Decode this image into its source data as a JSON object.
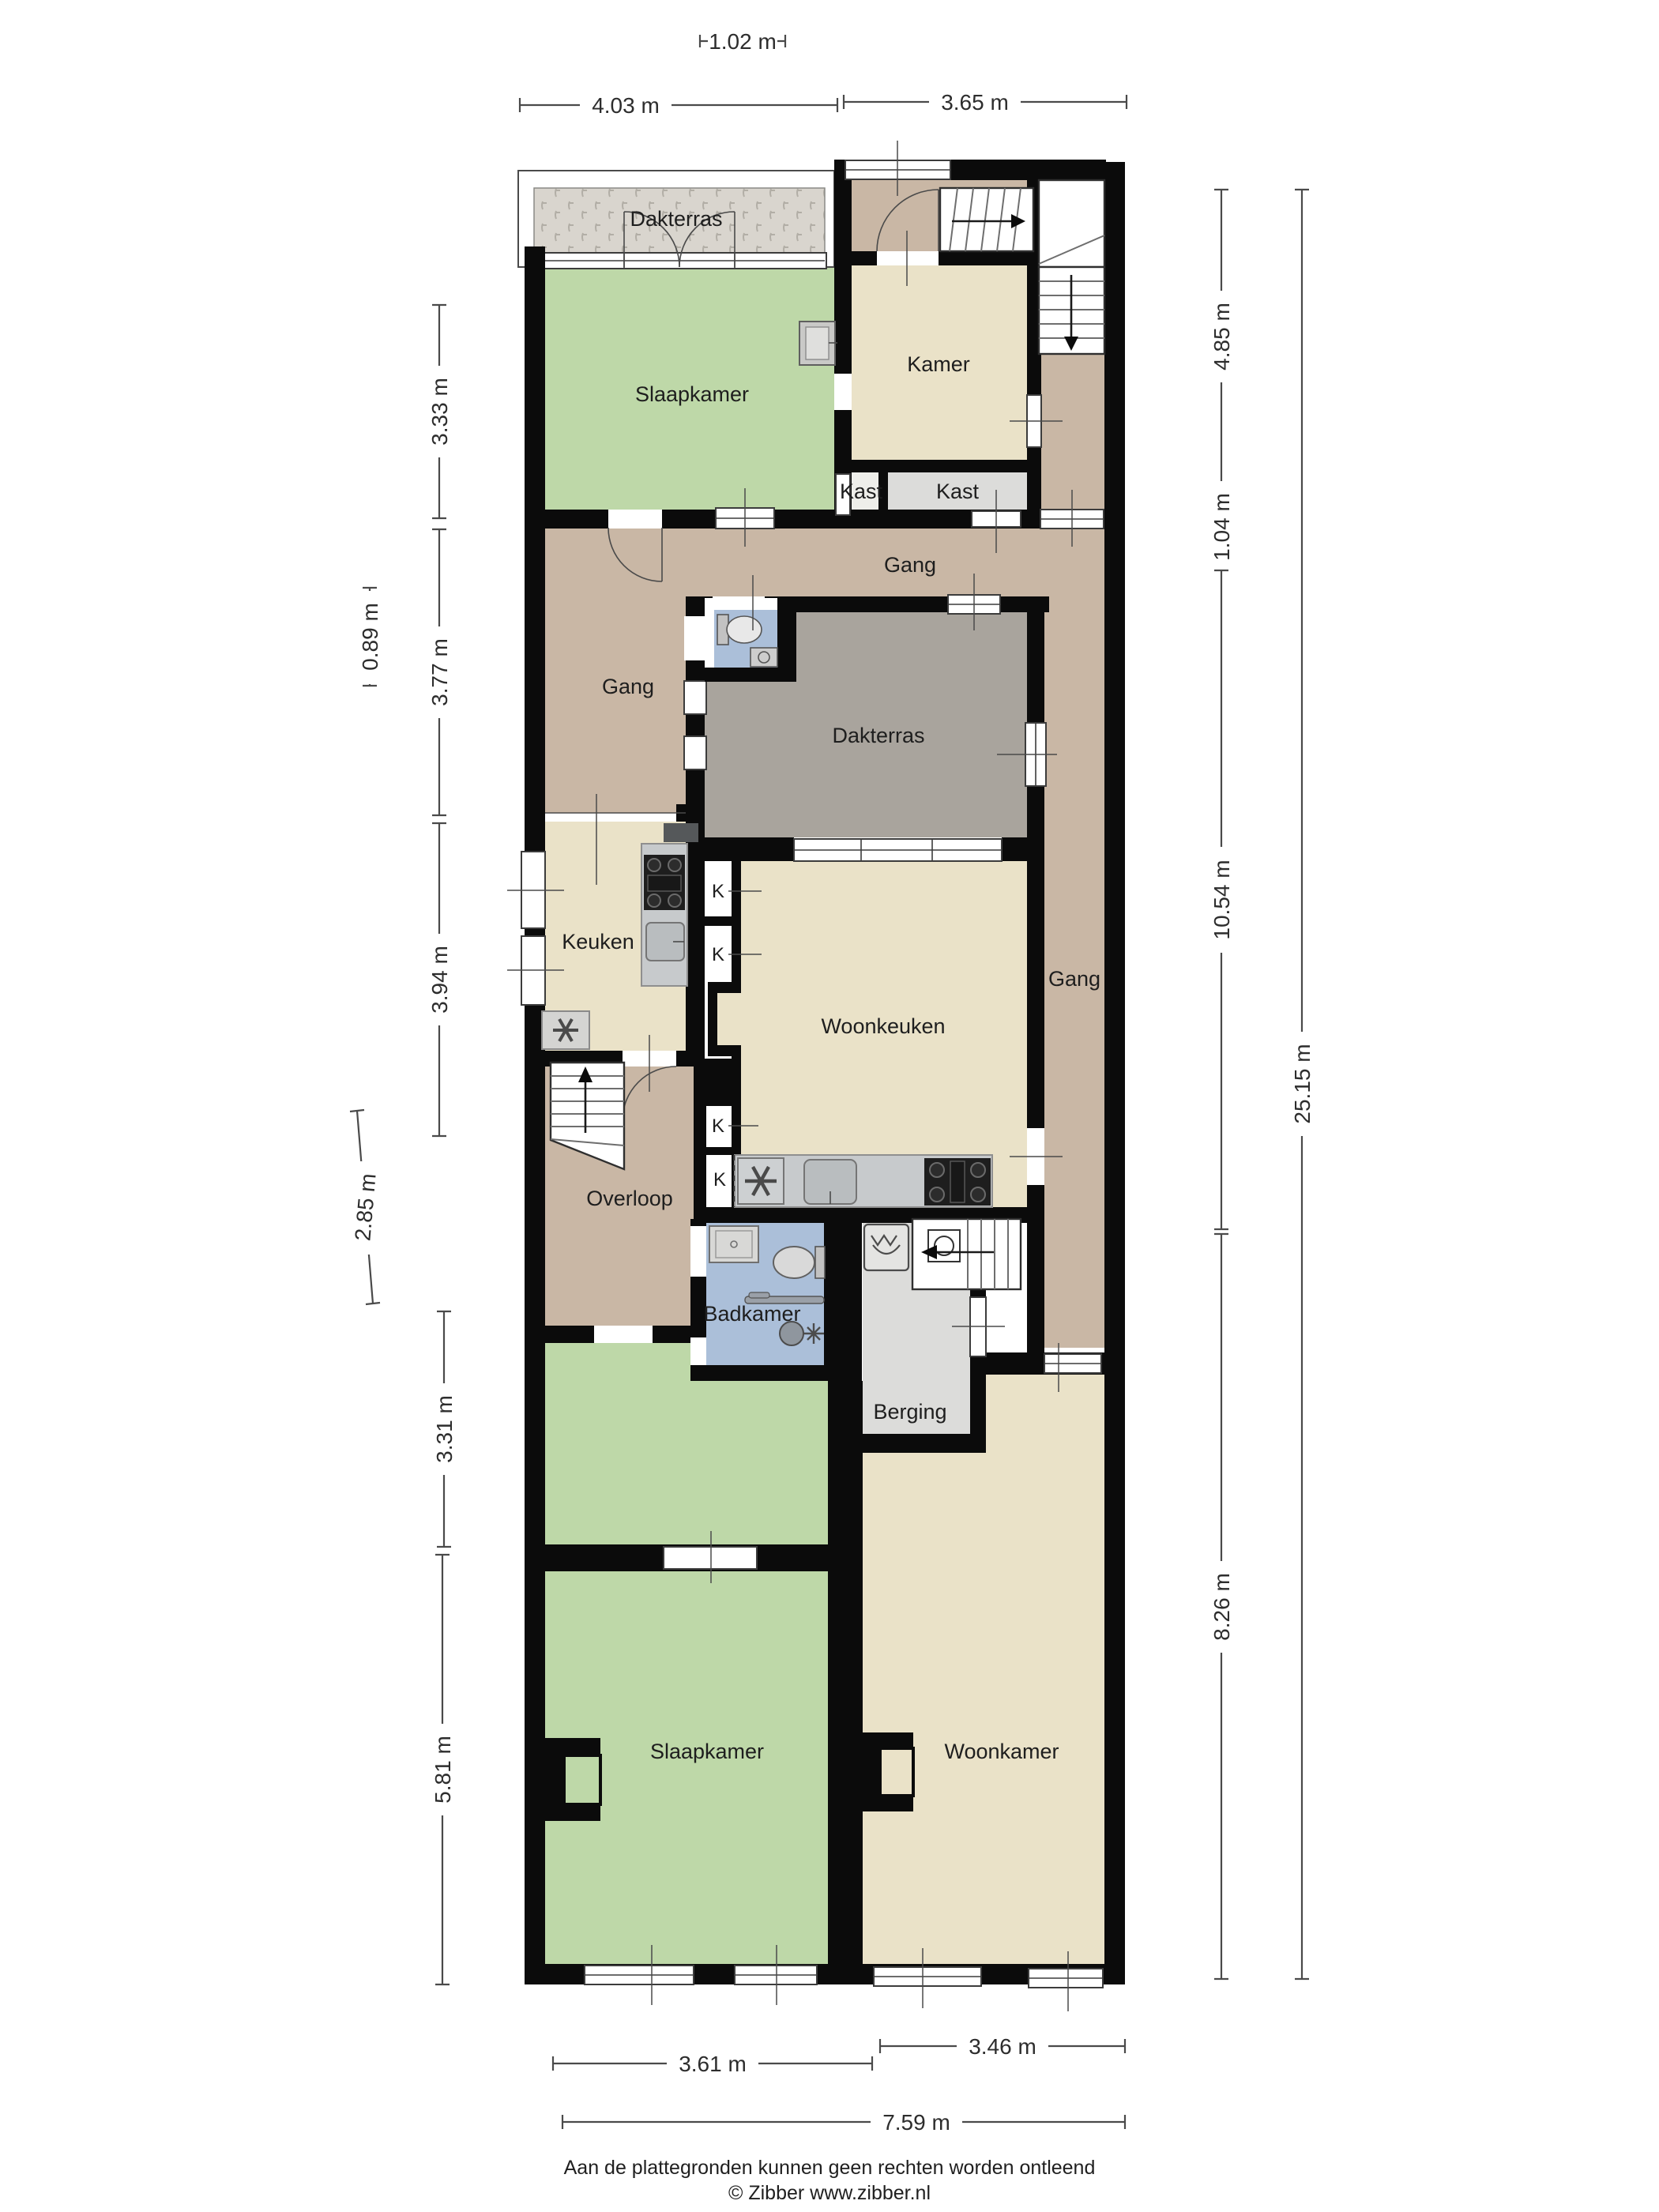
{
  "colors": {
    "wall": "#0b0b0b",
    "room_green": "#bed8a8",
    "room_beige": "#eae2c8",
    "room_brown": "#c9b7a5",
    "room_gray_terrace": "#a9a49d",
    "room_blue": "#abbfd9",
    "room_lightgray": "#dcdcda",
    "room_cell": "#eeeeea",
    "counter_gray": "#c7cacc",
    "stove_black": "#1e1e1e",
    "hatch_base": "#d9d5ce"
  },
  "rooms": [
    {
      "id": "dakterras-top",
      "label": "Dakterras"
    },
    {
      "id": "slaapkamer-top",
      "label": "Slaapkamer"
    },
    {
      "id": "kamer",
      "label": "Kamer"
    },
    {
      "id": "kast-small",
      "label": "Kast"
    },
    {
      "id": "kast-large",
      "label": "Kast"
    },
    {
      "id": "gang-top",
      "label": "Gang"
    },
    {
      "id": "gang-left",
      "label": "Gang"
    },
    {
      "id": "dakterras-mid",
      "label": "Dakterras"
    },
    {
      "id": "gang-right",
      "label": "Gang"
    },
    {
      "id": "keuken",
      "label": "Keuken"
    },
    {
      "id": "woonkeuken",
      "label": "Woonkeuken"
    },
    {
      "id": "overloop",
      "label": "Overloop"
    },
    {
      "id": "badkamer",
      "label": "Badkamer"
    },
    {
      "id": "berging",
      "label": "Berging"
    },
    {
      "id": "slaapkamer-bottom",
      "label": "Slaapkamer"
    },
    {
      "id": "woonkamer",
      "label": "Woonkamer"
    }
  ],
  "k_labels": [
    "K",
    "K",
    "K",
    "K"
  ],
  "dimensions": {
    "top": [
      {
        "label": "1.02 m"
      },
      {
        "label": "4.03 m"
      },
      {
        "label": "3.65 m"
      }
    ],
    "left": [
      {
        "label": "3.33 m"
      },
      {
        "label": "0.89 m"
      },
      {
        "label": "3.77 m"
      },
      {
        "label": "3.94 m"
      },
      {
        "label": "2.85 m"
      },
      {
        "label": "3.31 m"
      },
      {
        "label": "5.81 m"
      }
    ],
    "right": [
      {
        "label": "4.85 m"
      },
      {
        "label": "1.04 m"
      },
      {
        "label": "10.54 m"
      },
      {
        "label": "8.26 m"
      },
      {
        "label": "25.15 m"
      }
    ],
    "bottom": [
      {
        "label": "3.61 m"
      },
      {
        "label": "3.46 m"
      },
      {
        "label": "7.59 m"
      }
    ]
  },
  "footer": {
    "disclaimer": "Aan de plattegronden kunnen geen rechten worden ontleend",
    "copyright": "© Zibber www.zibber.nl"
  }
}
